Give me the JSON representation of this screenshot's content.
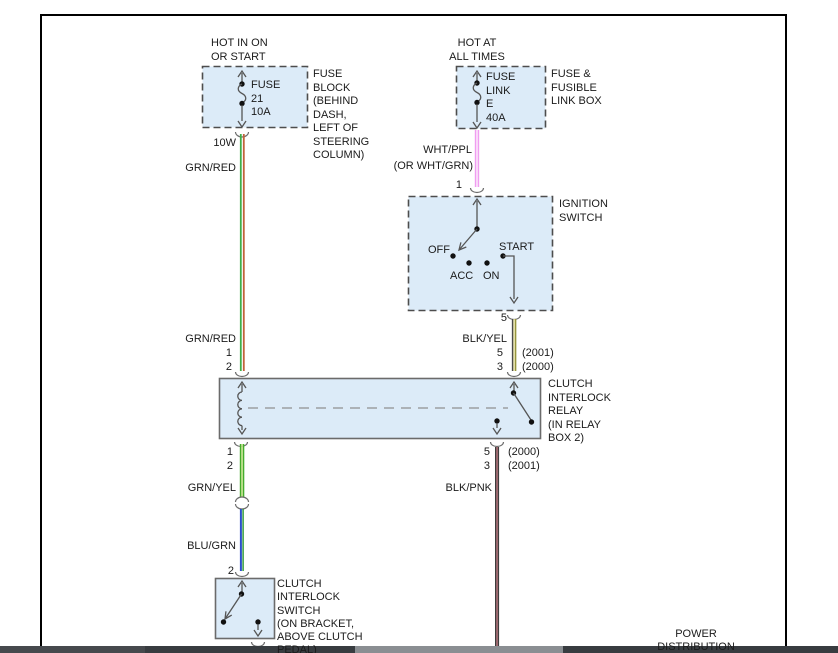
{
  "fuse_block": {
    "header": "HOT IN ON\nOR START",
    "fuse": "FUSE\n21\n10A",
    "name": "FUSE\nBLOCK\n(BEHIND\nDASH,\nLEFT OF\nSTEERING\nCOLUMN)",
    "wire_gauge": "10W"
  },
  "fusible_link": {
    "header": "HOT AT\nALL TIMES",
    "fuse": "FUSE\nLINK\nE\n40A",
    "name": "FUSE &\nFUSIBLE\nLINK BOX"
  },
  "ignition_switch": {
    "name": "IGNITION\nSWITCH",
    "pin_top": "1",
    "pin_bottom": "5",
    "pos_off": "OFF",
    "pos_acc": "ACC",
    "pos_on": "ON",
    "pos_start": "START"
  },
  "relay": {
    "name": "CLUTCH\nINTERLOCK\nRELAY\n(IN RELAY\nBOX 2)",
    "pins_top_left": "1\n2",
    "pins_top_right": "5\n3",
    "years_top_right": "(2001)\n(2000)",
    "pins_bottom_left": "1\n2",
    "pins_bottom_right": "5\n3",
    "years_bottom_right": "(2000)\n(2001)"
  },
  "clutch_switch": {
    "name": "CLUTCH\nINTERLOCK\nSWITCH\n(ON BRACKET,\nABOVE CLUTCH\nPEDAL)",
    "pin": "2"
  },
  "wires": {
    "grn_red": "GRN/RED",
    "wht_ppl": "WHT/PPL",
    "wht_ppl_alt": "(OR WHT/GRN)",
    "blk_yel": "BLK/YEL",
    "grn_yel": "GRN/YEL",
    "blu_grn": "BLU/GRN",
    "blk_pnk": "BLK/PNK"
  },
  "footer": {
    "power_distribution": "POWER\nDISTRIBUTION"
  },
  "colors": {
    "component_fill": "#dcebf8",
    "wire_green": "#3fae49",
    "wire_red": "#c2623a",
    "wire_pink": "#f09cf0",
    "wire_yellow": "#efe9ac",
    "wire_olive": "#96953d",
    "wire_blue": "#2b4ecb",
    "wire_dark": "#3d3d3d",
    "wire_pink_dark": "#bc6570",
    "frame": "#000000",
    "scrollbar_track": "#383c40",
    "scrollbar_thumb": "#8a8e92"
  }
}
